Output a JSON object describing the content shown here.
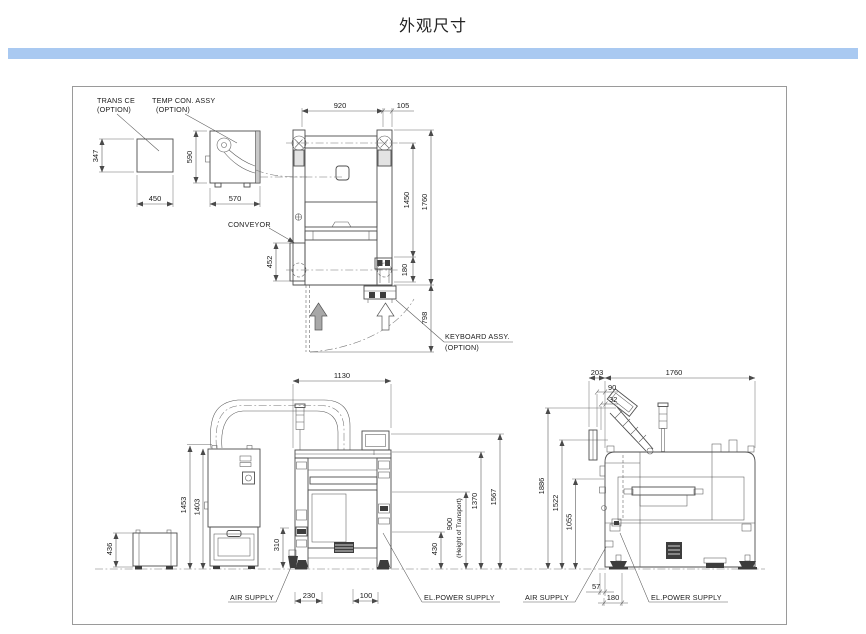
{
  "title": "外观尺寸",
  "colors": {
    "divider": "#a9c9f1",
    "line": "#4d4d4d"
  },
  "labels": {
    "trans_ce": "TRANS CE",
    "trans_ce_option": "(OPTION)",
    "temp_con": "TEMP CON. ASSY",
    "temp_con_option": "(OPTION)",
    "conveyor": "CONVEYOR",
    "keyboard": "KEYBOARD ASSY.",
    "keyboard_option": "(OPTION)",
    "air_supply_front": "AIR SUPPLY",
    "el_power_front": "EL.POWER SUPPLY",
    "air_supply_side": "AIR SUPPLY",
    "el_power_side": "EL.POWER SUPPLY",
    "height_of_transport": "(Height of Transport)"
  },
  "dims": {
    "trans_ce_h": "347",
    "trans_ce_w": "450",
    "temp_con_h": "590",
    "temp_con_w": "570",
    "top_w1": "920",
    "top_w2": "105",
    "top_h1": "1450",
    "top_h2": "1760",
    "top_conveyor": "452",
    "top_kb_offset": "180",
    "top_kb_depth": "798",
    "front_w": "1130",
    "front_cab_h1": "1453",
    "front_cab_h2": "1403",
    "front_cart_h": "436",
    "front_air_h": "310",
    "front_air_x": "230",
    "front_el_x": "100",
    "front_h1": "430",
    "front_h2": "900",
    "front_h3": "1370",
    "front_h4": "1567",
    "side_x1": "203",
    "side_x2": "90",
    "side_x3": "32",
    "side_w": "1760",
    "side_h1": "1886",
    "side_h2": "1522",
    "side_h3": "1055",
    "side_f1": "57",
    "side_f2": "180"
  }
}
